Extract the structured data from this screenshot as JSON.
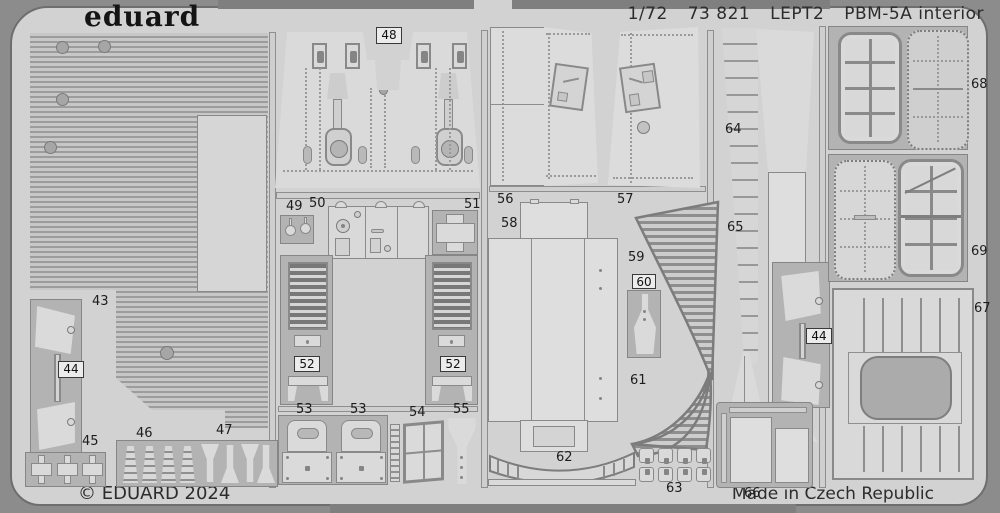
{
  "header": {
    "brand": "eduard",
    "scale": "1/72",
    "catalog": "73 821",
    "sheet_code": "LEPT2",
    "kit_title": "PBM-5A interior"
  },
  "footer": {
    "copyright": "© EDUARD 2024",
    "origin": "Made in Czech Republic"
  },
  "colors": {
    "outer_background": "#8c8c8c",
    "fret_background": "#d2d2d2",
    "carrier_metal": "#b3b3b3",
    "part_metal": "#dadada",
    "outline": "#7a7a7a",
    "text": "#1d1d1d"
  },
  "part_labels": {
    "43": "43",
    "44": "44",
    "45": "45",
    "46": "46",
    "47": "47",
    "48": "48",
    "49": "49",
    "50": "50",
    "51": "51",
    "52": "52",
    "53": "53",
    "54": "54",
    "55": "55",
    "56": "56",
    "57": "57",
    "58": "58",
    "59": "59",
    "60": "60",
    "61": "61",
    "62": "62",
    "63": "63",
    "64": "64",
    "65": "65",
    "66": "66",
    "67": "67",
    "68": "68",
    "69": "69"
  }
}
